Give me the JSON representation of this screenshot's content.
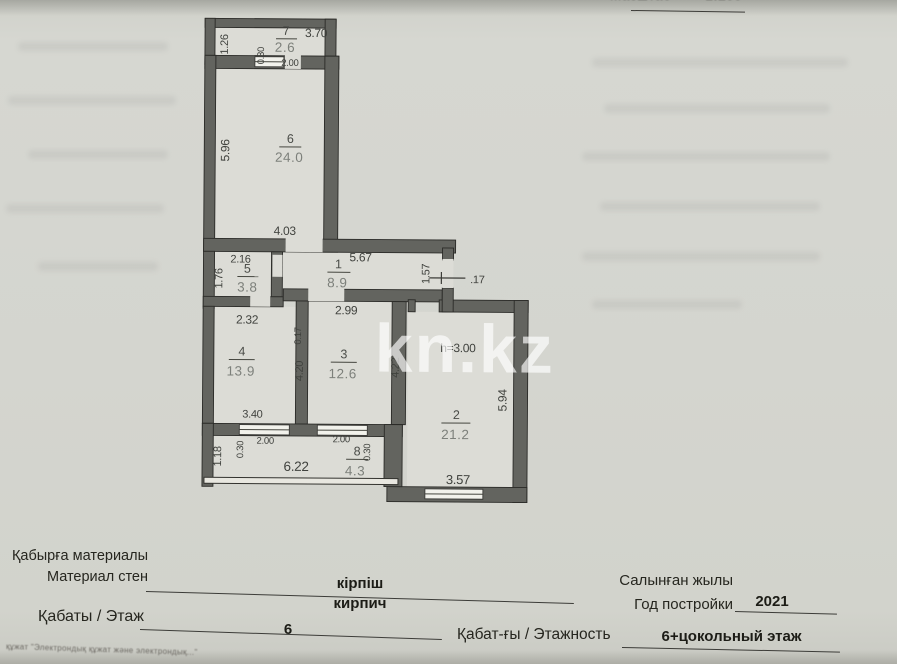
{
  "page": {
    "scale_label": "Масштаб",
    "scale_value": "1:200"
  },
  "watermark": "kn.kz",
  "colors": {
    "paper": "#d4d5cf",
    "paper_inner": "#dcdcd6",
    "wall": "#63645f",
    "ink": "#3f413d"
  },
  "plan": {
    "rooms": {
      "r7": {
        "num": "7",
        "area": "2.6"
      },
      "r6": {
        "num": "6",
        "area": "24.0"
      },
      "r5": {
        "num": "5",
        "area": "3.8"
      },
      "r1": {
        "num": "1",
        "area": "8.9"
      },
      "r4": {
        "num": "4",
        "area": "13.9"
      },
      "r3": {
        "num": "3",
        "area": "12.6"
      },
      "r2": {
        "num": "2",
        "area": "21.2"
      },
      "r8": {
        "num": "8",
        "area": "4.3"
      }
    },
    "dims": {
      "b7w": "3.70",
      "b7h": "1.26",
      "b7d1": "0.30",
      "b7d2": "2.00",
      "r6h": "5.96",
      "r6w": "4.03",
      "r5w": "2.16",
      "r5h": "1.76",
      "r1w": "5.67",
      "r1e": "1.57",
      "tick": ".17",
      "r4w": "2.32",
      "wall": "0.17",
      "r3w": "2.99",
      "r4h": "4.20",
      "r3h": "4.22",
      "r4b": "3.40",
      "ceiling": "h=3.00",
      "r2h": "5.94",
      "r2b": "3.57",
      "r8h": "1.18",
      "r8a": "0.30",
      "r8b": "2.00",
      "r8c": "2.00",
      "r8d": "0.30",
      "r8w": "6.22"
    }
  },
  "form": {
    "wall_material": {
      "label_kk": "Қабырға материалы",
      "label_ru": "Материал стен",
      "value_kk": "кірпіш",
      "value_ru": "кирпич"
    },
    "floor": {
      "label": "Қабаты / Этаж",
      "value": "6"
    },
    "build_year": {
      "label_kk": "Салынған жылы",
      "label_ru": "Год постройки",
      "value": "2021"
    },
    "floors_total": {
      "label": "Қабат-ғы / Этажность",
      "value": "6+цокольный этаж"
    }
  },
  "footnote": "құжат \"Электрондық құжат және электрондық...\""
}
